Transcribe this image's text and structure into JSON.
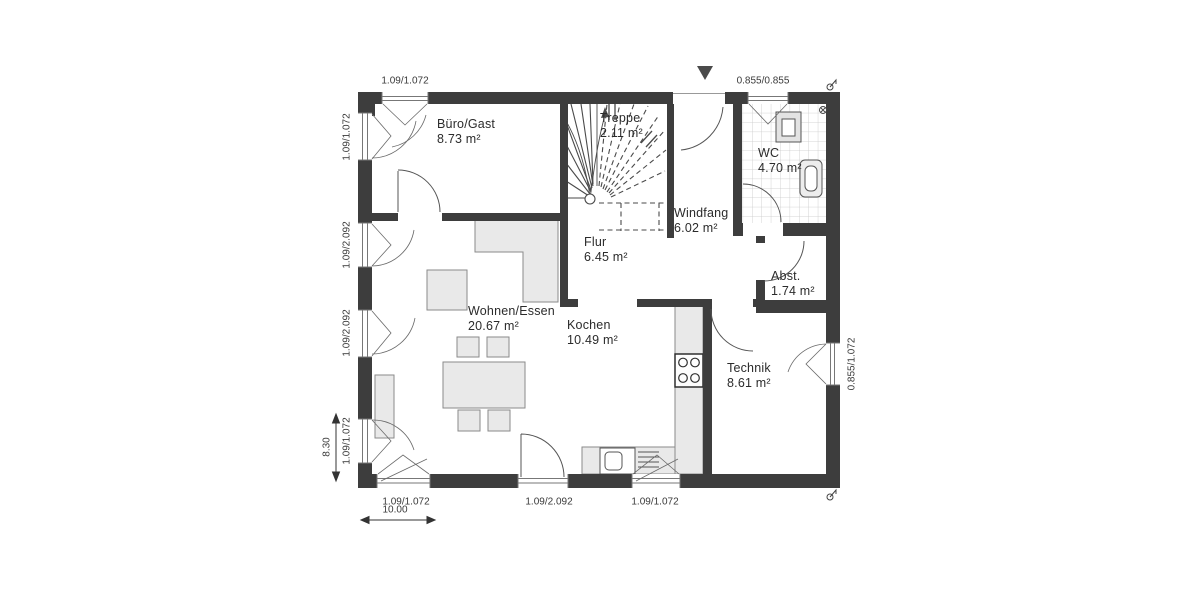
{
  "plan": {
    "title": "floor-plan-ground-floor",
    "rooms": [
      {
        "name": "Büro/Gast",
        "area": "8.73 m²"
      },
      {
        "name": "Treppe",
        "area": "2.11 m²"
      },
      {
        "name": "WC",
        "area": "4.70 m²"
      },
      {
        "name": "Windfang",
        "area": "6.02 m²"
      },
      {
        "name": "Flur",
        "area": "6.45 m²"
      },
      {
        "name": "Abst.",
        "area": "1.74 m²"
      },
      {
        "name": "Wohnen/Essen",
        "area": "20.67 m²"
      },
      {
        "name": "Kochen",
        "area": "10.49 m²"
      },
      {
        "name": "Technik",
        "area": "8.61 m²"
      }
    ],
    "dims": {
      "top_left": "1.09/1.072",
      "top_right": "0.855/0.855",
      "left_1": "1.09/1.072",
      "left_2": "1.09/2.092",
      "left_3": "1.09/2.092",
      "left_4": "1.09/1.072",
      "left_total": "8.30",
      "right_1": "0.855/1.072",
      "bottom_1": "1.09/1.072",
      "bottom_2": "1.09/2.092",
      "bottom_3": "1.09/1.072",
      "bottom_total": "10.00"
    },
    "icons": {
      "entrance_arrow": "filled-triangle-down",
      "benchmark_marker": "circle-with-flag",
      "vent_symbol": "circle-with-x"
    },
    "colors": {
      "wall": "#3d3d3d",
      "furniture_fill": "#e9e9e9",
      "line": "#555555",
      "tile_grid": "#c9c9c9"
    }
  }
}
